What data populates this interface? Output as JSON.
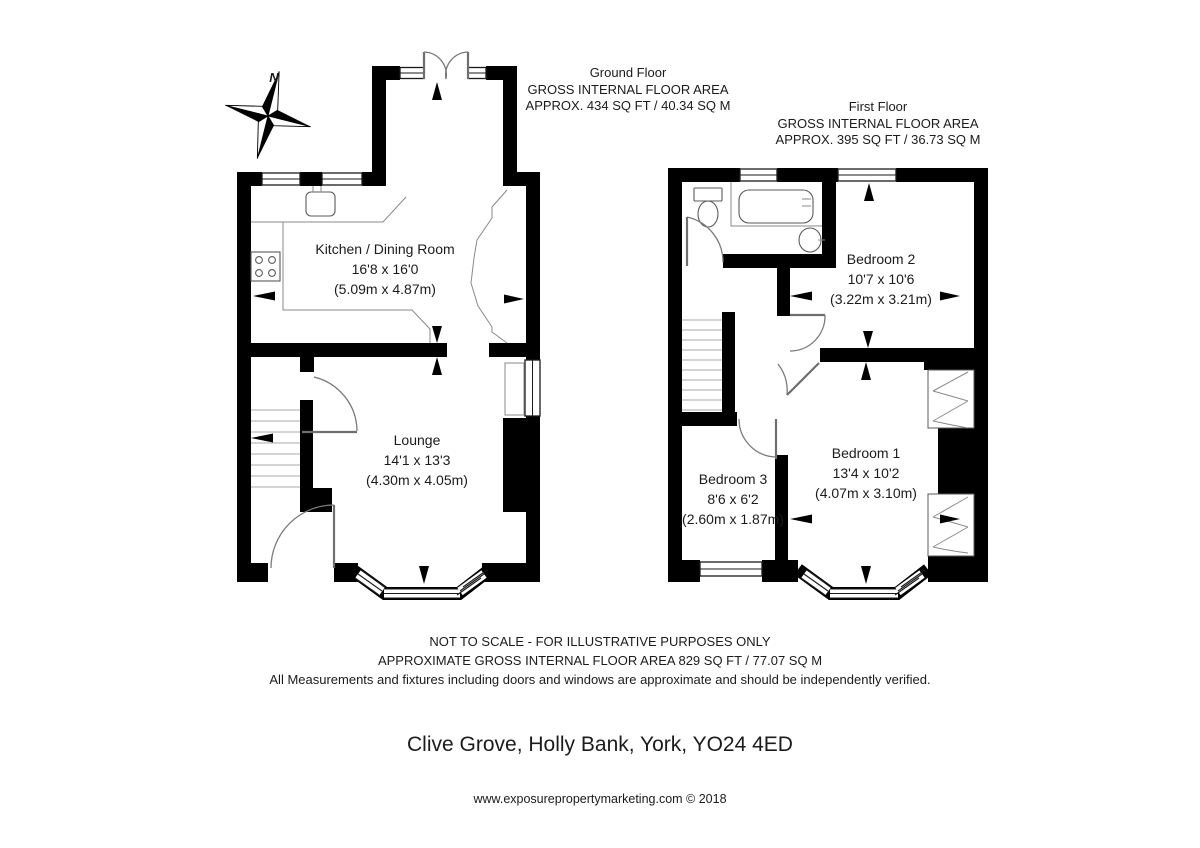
{
  "meta": {
    "compass_label": "N"
  },
  "colors": {
    "walls": "#000000",
    "background": "#ffffff",
    "text": "#1b1b1b"
  },
  "ground_floor": {
    "header": {
      "title": "Ground Floor",
      "line2": "GROSS INTERNAL FLOOR AREA",
      "line3": "APPROX. 434 SQ FT / 40.34 SQ M"
    },
    "rooms": [
      {
        "id": "kitchen",
        "name": "Kitchen / Dining Room",
        "imperial": "16'8 x 16'0",
        "metric": "(5.09m x 4.87m)"
      },
      {
        "id": "lounge",
        "name": "Lounge",
        "imperial": "14'1 x 13'3",
        "metric": "(4.30m x 4.05m)"
      }
    ]
  },
  "first_floor": {
    "header": {
      "title": "First Floor",
      "line2": "GROSS INTERNAL FLOOR AREA",
      "line3": "APPROX. 395 SQ FT / 36.73 SQ M"
    },
    "rooms": [
      {
        "id": "bedroom2",
        "name": "Bedroom 2",
        "imperial": "10'7 x 10'6",
        "metric": "(3.22m x 3.21m)"
      },
      {
        "id": "bedroom3",
        "name": "Bedroom 3",
        "imperial": "8'6 x 6'2",
        "metric": "(2.60m x 1.87m)"
      },
      {
        "id": "bedroom1",
        "name": "Bedroom 1",
        "imperial": "13'4 x 10'2",
        "metric": "(4.07m x 3.10m)"
      }
    ]
  },
  "footer": {
    "line1": "NOT TO SCALE - FOR ILLUSTRATIVE PURPOSES ONLY",
    "line2": "APPROXIMATE GROSS INTERNAL FLOOR AREA 829 SQ FT / 77.07 SQ M",
    "line3": "All Measurements and fixtures including doors and windows are approximate and should be independently verified."
  },
  "address": "Clive Grove, Holly Bank, York, YO24 4ED",
  "credit": "www.exposurepropertymarketing.com © 2018"
}
